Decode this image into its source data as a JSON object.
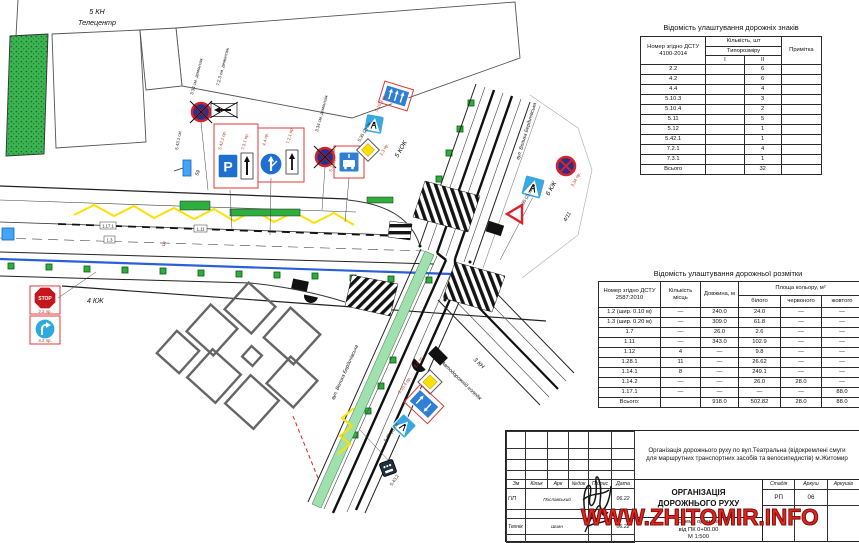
{
  "watermark": "WWW.ZHITOMIR.INFO",
  "colors": {
    "sign_blue": "#2f7fd6",
    "deep_blue": "#26318f",
    "sign_red": "#d8232a",
    "frame_red": "#e03a3a",
    "green": "#2eae3c",
    "bike_green": "#9fe0ae",
    "yellow": "#ffe000",
    "blue_line": "#2b5fd9",
    "watermark_red": "#e8231e"
  },
  "map": {
    "labels": {
      "kn5": "5 КН",
      "telecentr": "Телецентр",
      "kok5": "5 КОК",
      "kzh6": "6 КЖ",
      "kzh4": "4 КЖ",
      "kn3": "3 КН",
      "college": "Автодорожній коледж",
      "street": "вул. Велика Бердичівська",
      "house411": "4/11",
      "n59": "59",
      "red3": "3"
    },
    "tags": {
      "t1": "1.17.1",
      "t2": "1.11",
      "t3": "1.3"
    },
    "sign_labels": {
      "demount_334": "3.34 см. демонтаж",
      "demount_723": "7.2.3 см. демонтаж",
      "p_5421": "5.42.1 пр.",
      "a_731": "7.3.1 пр.",
      "c_44": "4.4 пр.",
      "a_721": "7.2.1 пр.",
      "b_511": "5.11 пр.",
      "l_5103": "5.10.3 пр.",
      "l_5104": "5.10.4 пр.",
      "ped_535": "5.35 (2) см.",
      "d_23": "2.3 пр.",
      "stop_22": "2.2 пр.",
      "t_42": "4.2 пр.",
      "ns_334": "3.34 пр.",
      "r_5432": "5.43.2",
      "r_5431": "5.43.1 см.",
      "stop_text": "STOP",
      "p_text": "P"
    }
  },
  "signs_table": {
    "title": "Відомість улаштування  дорожніх знаків",
    "col_number": "Номер згідно ДСТУ 4100-2014",
    "col_qty": "Кількість, шт",
    "col_size": "Типорозміру",
    "col_i": "I",
    "col_ii": "II",
    "col_note": "Примітка",
    "rows": [
      [
        "2.2",
        "",
        "6",
        ""
      ],
      [
        "4.2",
        "",
        "6",
        ""
      ],
      [
        "4.4",
        "",
        "4",
        ""
      ],
      [
        "5.10.3",
        "",
        "3",
        ""
      ],
      [
        "5.10.4",
        "",
        "2",
        ""
      ],
      [
        "5.11",
        "",
        "5",
        ""
      ],
      [
        "5.12",
        "",
        "1",
        ""
      ],
      [
        "5.42.1",
        "",
        "1",
        ""
      ],
      [
        "7.2.1",
        "",
        "4",
        ""
      ],
      [
        "7.3.1",
        "",
        "1",
        ""
      ],
      [
        "Всього",
        "",
        "32",
        ""
      ]
    ]
  },
  "markings_table": {
    "title": "Відомість улаштування дорожньої розмітки",
    "col_number": "Номер згідно ДСТУ 2587:2010",
    "col_places": "Кількість місць",
    "col_length": "Довжина, м",
    "col_area": "Площа кольору, м²",
    "col_white": "білого",
    "col_red": "червоного",
    "col_yellow": "жовтого",
    "rows": [
      [
        "1.2 (шир. 0.10 м)",
        "—",
        "240.0",
        "24.0",
        "—",
        "—"
      ],
      [
        "1.3 (шир. 0.20 м)",
        "—",
        "309.0",
        "61.8",
        "—",
        "—"
      ],
      [
        "1.7",
        "—",
        "26.0",
        "2.6",
        "—",
        "—"
      ],
      [
        "1.11",
        "—",
        "343.0",
        "102.9",
        "—",
        "—"
      ],
      [
        "1.12",
        "4",
        "—",
        "9.8",
        "—",
        "—"
      ],
      [
        "1.28.1",
        "11",
        "—",
        "26.62",
        "—",
        "—"
      ],
      [
        "1.14.1",
        "8",
        "—",
        "249.1",
        "—",
        "—"
      ],
      [
        "1.14.2",
        "—",
        "—",
        "26.0",
        "28.0",
        "—"
      ],
      [
        "1.17.1",
        "—",
        "—",
        "—",
        "—",
        "88.0"
      ],
      [
        "Всього:",
        "",
        "918.0",
        "502.82",
        "28.0",
        "88.0"
      ]
    ]
  },
  "title_block": {
    "cols": [
      "Зм",
      "Кільк",
      "Арк",
      "№док",
      "Підпис",
      "Дата"
    ],
    "row_gip": {
      "role": "ГІП",
      "name": "Пославський",
      "date": "06.22"
    },
    "row_tech": {
      "role": "Технік",
      "name": "Шиян",
      "date": "06.22"
    },
    "project": "Організація дорожнього руху по вул.Театральна (відокремлені смуги для маршрутних транспортних засобів та велосипедистів) м.Житомир",
    "main_title": "ОРГАНІЗАЦІЯ  ДОРОЖНЬОГО  РУХУ",
    "stage_label": "Стадія",
    "sheet_label": "Аркуш",
    "sheets_label": "Аркушів",
    "stage": "РП",
    "sheet": "06",
    "sheets": "",
    "scheme_line1": "Схема організа",
    "scheme_line2": "від ПК 0+00.00",
    "scheme_line3": "М 1:500"
  }
}
